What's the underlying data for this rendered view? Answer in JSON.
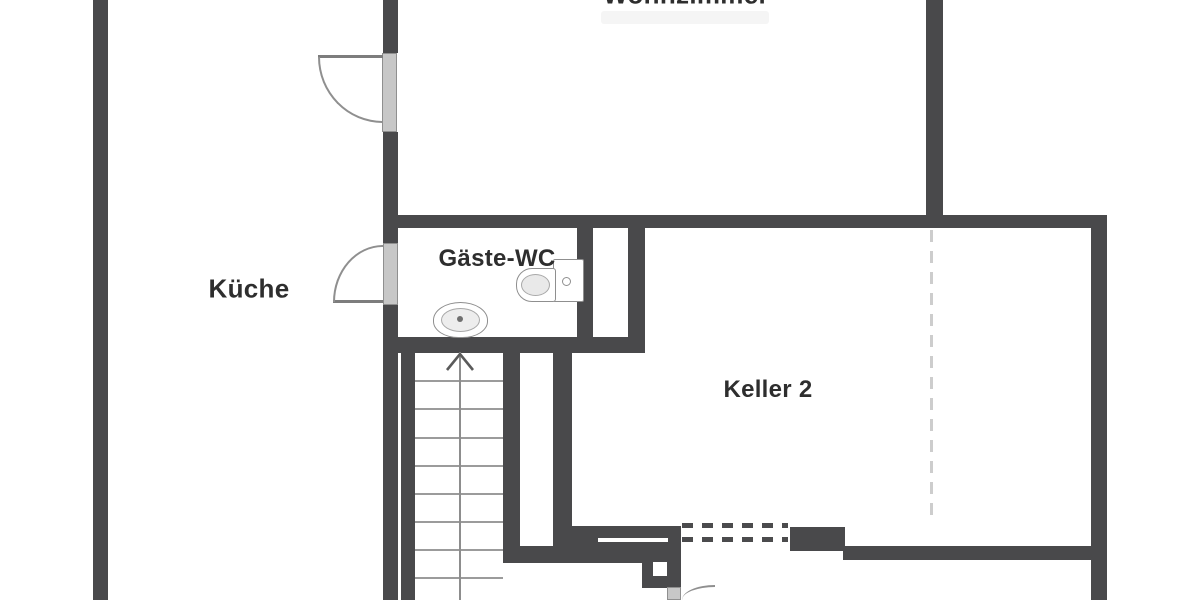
{
  "plan": {
    "title": "floor-plan",
    "rooms": {
      "wohnzimmer": {
        "label": "Wohnzimmer"
      },
      "kueche": {
        "label": "Küche"
      },
      "gaeste_wc": {
        "label": "Gäste-WC"
      },
      "keller2": {
        "label": "Keller 2"
      }
    },
    "fixtures": {
      "toilet": "toilet",
      "sink": "sink",
      "stairs": "double-flight-stairs-up-arrow"
    },
    "colors": {
      "wall": "#49494b",
      "door_leaf": "#c7c7c7",
      "swing_arc": "#8f8f8f",
      "stair_line": "#9b9b9b",
      "dashed_opening_dark": "#4b4b4d",
      "dashed_line_light": "#cdcdcd",
      "label_text": "#2e2e2e"
    }
  }
}
